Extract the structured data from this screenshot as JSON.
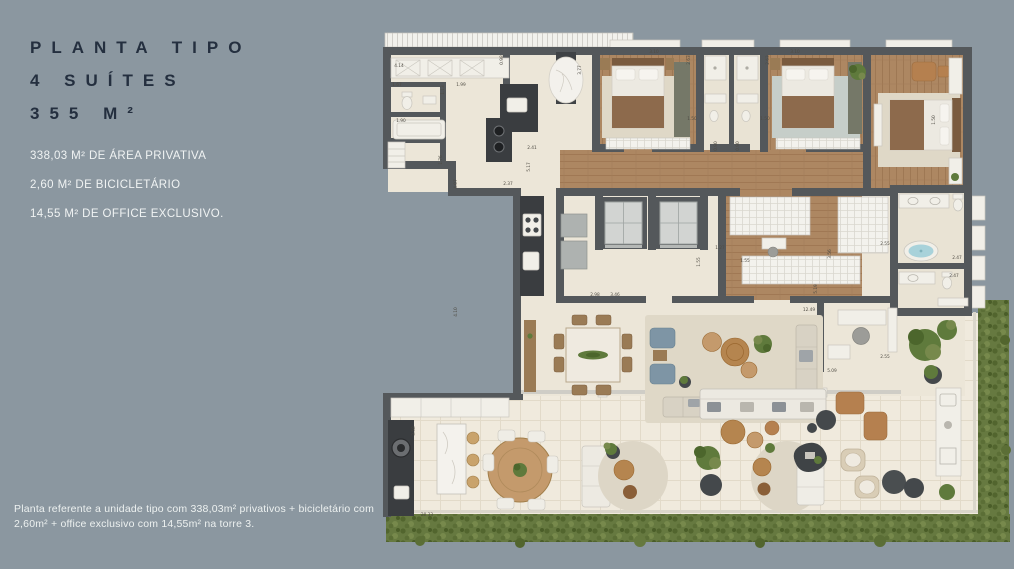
{
  "info_panel": {
    "title_line1": "PLANTA TIPO",
    "title_line2": "4 SUÍTES",
    "title_line3": "355 M²",
    "details": [
      "338,03 M² DE ÁREA PRIVATIVA",
      "2,60 M² DE BICICLETÁRIO",
      "14,55 M² DE OFFICE EXCLUSIVO."
    ]
  },
  "disclaimer": "Planta referente a unidade tipo com 338,03m² privativos + bicicletário com 2,60m² + office exclusivo com 14,55m² na torre 3.",
  "colors": {
    "background": "#8B97A0",
    "title_text": "#242F3F",
    "light_text": "#F0F3F3",
    "wall": "#54585B",
    "floor": "#ECE6D8",
    "terrace_tile": "#F0EADD",
    "wood_floor": "#AD8762",
    "counter_dark": "#3A3D40",
    "hedge_green": "#667940",
    "leather": "#B5804F",
    "water": "#A8D2DA"
  },
  "floor_plan": {
    "dimension_labels": [
      {
        "t": "4.14",
        "x": 399,
        "y": 67
      },
      {
        "t": "0.98",
        "x": 503,
        "y": 60,
        "v": 1
      },
      {
        "t": "3.77",
        "x": 581,
        "y": 70,
        "v": 1
      },
      {
        "t": "1.67",
        "x": 397,
        "y": 86
      },
      {
        "t": "1.13",
        "x": 444,
        "y": 90,
        "v": 1
      },
      {
        "t": "1.99",
        "x": 461,
        "y": 86
      },
      {
        "t": "1.90",
        "x": 401,
        "y": 122
      },
      {
        "t": "2.41",
        "x": 532,
        "y": 149
      },
      {
        "t": "1.76",
        "x": 442,
        "y": 160,
        "v": 1
      },
      {
        "t": "5.17",
        "x": 530,
        "y": 167,
        "v": 1
      },
      {
        "t": "4.07",
        "x": 457,
        "y": 184,
        "v": 1
      },
      {
        "t": "2.37",
        "x": 508,
        "y": 185
      },
      {
        "t": "3.10",
        "x": 654,
        "y": 53
      },
      {
        "t": "2.63",
        "x": 690,
        "y": 60,
        "v": 1
      },
      {
        "t": "3.10",
        "x": 795,
        "y": 53
      },
      {
        "t": "2.63",
        "x": 769,
        "y": 60,
        "v": 1
      },
      {
        "t": "1.50",
        "x": 692,
        "y": 120
      },
      {
        "t": "1.50",
        "x": 765,
        "y": 120
      },
      {
        "t": "0.90",
        "x": 717,
        "y": 146,
        "v": 1
      },
      {
        "t": "0.90",
        "x": 739,
        "y": 146,
        "v": 1
      },
      {
        "t": "1.50",
        "x": 935,
        "y": 120,
        "v": 1
      },
      {
        "t": "2.55",
        "x": 885,
        "y": 245
      },
      {
        "t": "2.47",
        "x": 957,
        "y": 259
      },
      {
        "t": "2.47",
        "x": 954,
        "y": 277
      },
      {
        "t": "1.27",
        "x": 720,
        "y": 249
      },
      {
        "t": "1.55",
        "x": 700,
        "y": 262,
        "v": 1
      },
      {
        "t": "1.55",
        "x": 745,
        "y": 262
      },
      {
        "t": "2.98",
        "x": 595,
        "y": 296
      },
      {
        "t": "3.46",
        "x": 615,
        "y": 296
      },
      {
        "t": "4.10",
        "x": 457,
        "y": 312,
        "v": 1
      },
      {
        "t": "12.49",
        "x": 809,
        "y": 311
      },
      {
        "t": "3.56",
        "x": 831,
        "y": 254,
        "v": 1
      },
      {
        "t": "5.19",
        "x": 817,
        "y": 289,
        "v": 1
      },
      {
        "t": "5.09",
        "x": 832,
        "y": 372
      },
      {
        "t": "2.55",
        "x": 885,
        "y": 358
      },
      {
        "t": "3.58",
        "x": 415,
        "y": 431,
        "v": 1
      },
      {
        "t": "20.33",
        "x": 427,
        "y": 516
      }
    ]
  }
}
